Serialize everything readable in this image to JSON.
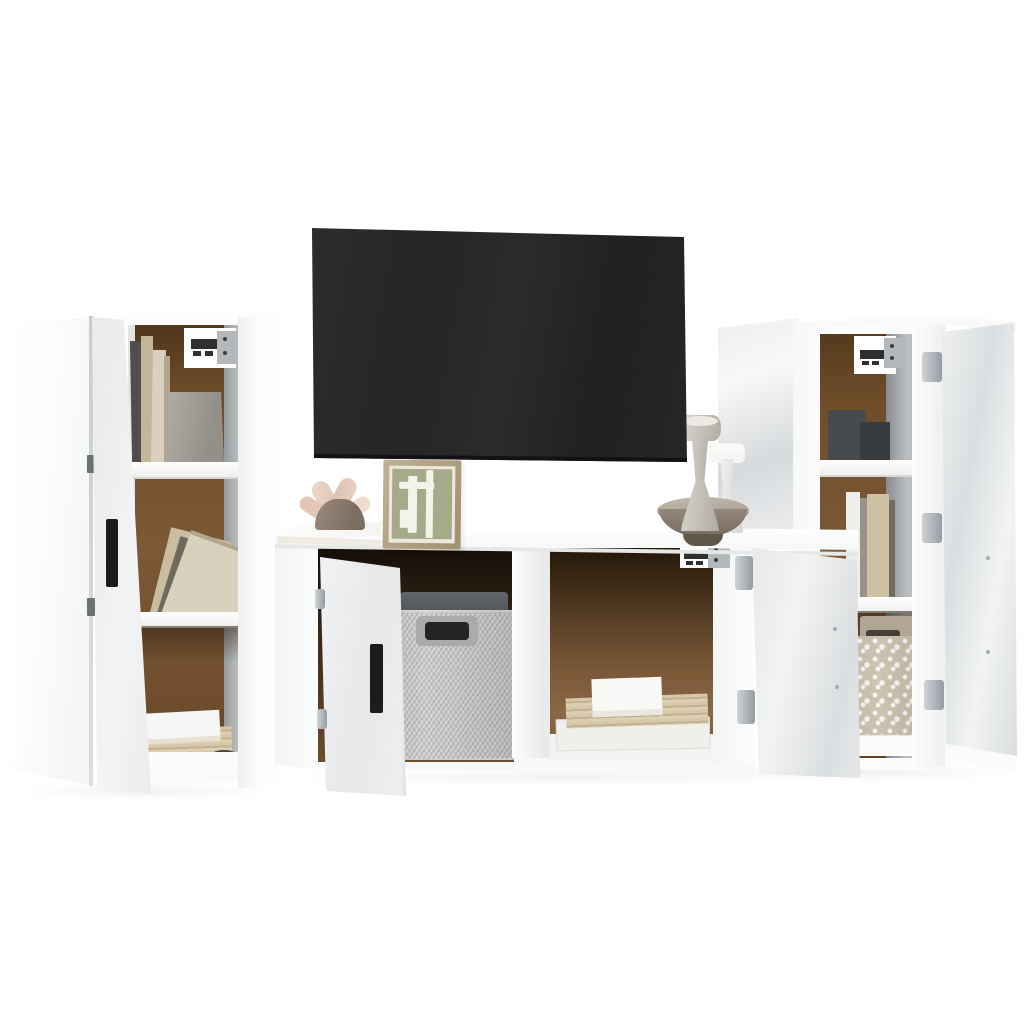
{
  "scene": {
    "description": "Product photo of a white high-gloss wall-mounted TV furniture set on a white studio background: two tall side cabinets on the left (one closed, one open with shelves of books and a concrete vase), a wall-mounted flat-screen TV above a TV bench with open doors holding a grey fabric basket and stacked books, and a tall open cabinet on the right with books and a floral fabric basket. Decor includes a picture frame, an abstract plant figurine on a white book, and candle holders in a bowl."
  },
  "palette": {
    "background": "#ffffff",
    "white_face": "#fdfdfd",
    "gloss_light": "#f1f3f4",
    "gloss_mid": "#dbdee0",
    "gloss_dark": "#d7dadc",
    "tv_screen": "#242527",
    "tv_edge": "#121214",
    "hardboard": "#6f4d2b",
    "hardboard_dark": "#4f3820",
    "hardboard_light": "#8a6745",
    "inner_wall": "#a9acae",
    "handle_black": "#1c1c1e",
    "basket_gray": "#c6c8c7",
    "basket_rim": "#494c4f",
    "floral_base": "#cdc3b1",
    "floral_handle": "#474039",
    "book_tan": "#cfc2a4",
    "book_cream": "#d9d1bd",
    "book_dark": "#4f4e4c",
    "plywood_light": "#d6c8a8",
    "vase_gray": "#938f89",
    "figurine_dome": "#7d6e64",
    "figurine_petal": "#e7cfc2",
    "frame_wood": "#a09070",
    "frame_art": "#a7aa8a",
    "candle_beige": "#d6d2ca",
    "candle_white": "#f7f6f4",
    "bowl_brown": "#786b5f",
    "bracket_metal": "#b4b8ba",
    "bracket_dark": "#2f2f31",
    "hinge_silver": "#959da2"
  },
  "objects": [
    {
      "id": 0,
      "label": "left closed tall cabinet, white"
    },
    {
      "id": 1,
      "label": "left open tall cabinet with three shelves"
    },
    {
      "id": 2,
      "label": "open door of left cabinet with black handle"
    },
    {
      "id": 3,
      "label": "wall-mounted flat screen TV, dark"
    },
    {
      "id": 4,
      "label": "white TV bench with open compartments"
    },
    {
      "id": 5,
      "label": "open left door of TV bench with black handle"
    },
    {
      "id": 6,
      "label": "open right door of TV bench, glossy white"
    },
    {
      "id": 7,
      "label": "grey herringbone fabric storage basket"
    },
    {
      "id": 8,
      "label": "beige floral fabric storage basket"
    },
    {
      "id": 9,
      "label": "right closed tall cabinet panel, glossy white"
    },
    {
      "id": 10,
      "label": "right open tall cabinet with three shelves"
    },
    {
      "id": 11,
      "label": "open door of right cabinet, glossy white"
    },
    {
      "id": 12,
      "label": "white decor book on bench top"
    },
    {
      "id": 13,
      "label": "abstract plant figurine with pink leaves"
    },
    {
      "id": 14,
      "label": "wooden picture frame with abstract sage art"
    },
    {
      "id": 15,
      "label": "candle holders in brown bowl"
    },
    {
      "id": 16,
      "label": "wall mounting brackets"
    },
    {
      "id": 17,
      "label": "stacked books and plywood boards"
    },
    {
      "id": 18,
      "label": "grey concrete vase"
    }
  ]
}
